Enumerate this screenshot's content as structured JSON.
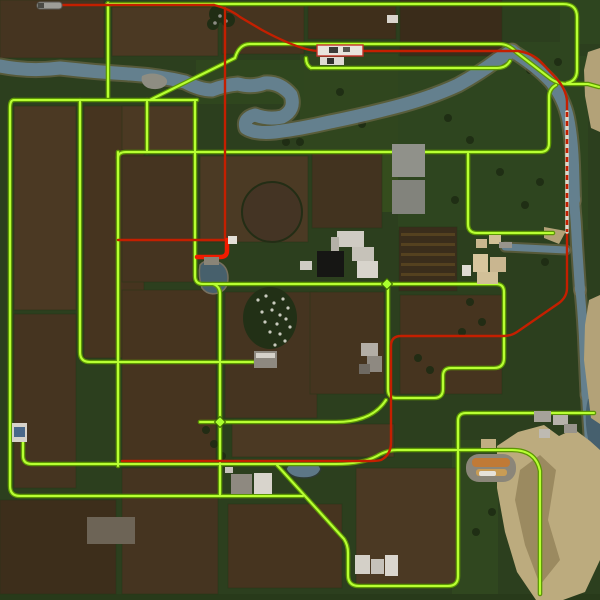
{
  "meta": {
    "type": "game-minimap",
    "description": "Top-down farming-game overview map: brown field grid, meandering river, road network highlighted bright green, railway route highlighted red, farms, ponds, racetrack and cliffs",
    "visible_text": []
  },
  "colors": {
    "base_grass": "#2c3f1e",
    "road_core": "#b8ff33",
    "road_casing": "#5c9604",
    "rail_red": "#c41f00",
    "rail_red_bright": "#f01b00",
    "river": "#64808e",
    "river_bank": "#7b7152",
    "cliff_tan": "#b3a278",
    "field_brown": "#46341f"
  },
  "map": {
    "width": 600,
    "height": 600,
    "base": "#2c3f1e",
    "patches": [
      [
        398,
        56,
        190,
        174,
        "#2e451f"
      ],
      [
        452,
        440,
        46,
        156,
        "#30471f"
      ],
      [
        198,
        416,
        36,
        52,
        "#2a3f1c"
      ],
      [
        300,
        54,
        98,
        96,
        "#30461e"
      ],
      [
        352,
        150,
        46,
        62,
        "#354d1d"
      ],
      [
        505,
        42,
        72,
        38,
        "#2e451f"
      ],
      [
        560,
        0,
        40,
        44,
        "#2e451f"
      ],
      [
        196,
        60,
        108,
        44,
        "#2f461e"
      ],
      [
        0,
        594,
        600,
        6,
        "#283a1a"
      ]
    ],
    "fields": [
      [
        0,
        0,
        104,
        58,
        "#453420"
      ],
      [
        112,
        7,
        106,
        49,
        "#4b3923"
      ],
      [
        222,
        6,
        82,
        48,
        "#46341f"
      ],
      [
        308,
        6,
        88,
        33,
        "#3f2f1b"
      ],
      [
        400,
        0,
        102,
        56,
        "#3a2c1a"
      ],
      [
        14,
        106,
        62,
        204,
        "#4b3923"
      ],
      [
        14,
        314,
        62,
        174,
        "#453420"
      ],
      [
        84,
        106,
        60,
        252,
        "#46341f"
      ],
      [
        122,
        106,
        74,
        44,
        "#4b3923"
      ],
      [
        122,
        156,
        71,
        126,
        "#453420"
      ],
      [
        200,
        156,
        108,
        86,
        "#4b3a24"
      ],
      [
        122,
        290,
        94,
        170,
        "#46341f"
      ],
      [
        225,
        292,
        92,
        126,
        "#453420"
      ],
      [
        312,
        152,
        70,
        76,
        "#42331f"
      ],
      [
        399,
        227,
        58,
        64,
        "#3a2d1b"
      ],
      [
        400,
        295,
        102,
        99,
        "#46341f"
      ],
      [
        310,
        292,
        74,
        102,
        "#45341f"
      ],
      [
        232,
        424,
        162,
        33,
        "#4b3923"
      ],
      [
        122,
        468,
        96,
        126,
        "#453420"
      ],
      [
        228,
        504,
        114,
        84,
        "#46341f"
      ],
      [
        356,
        468,
        100,
        116,
        "#4b3923"
      ],
      [
        0,
        500,
        116,
        94,
        "#3d2e1b"
      ]
    ],
    "field_rows": [
      [
        401,
        233,
        54,
        3,
        "#54411f"
      ],
      [
        401,
        243,
        54,
        3,
        "#54411f"
      ],
      [
        401,
        253,
        54,
        3,
        "#54411f"
      ],
      [
        401,
        263,
        54,
        3,
        "#54411f"
      ],
      [
        401,
        273,
        54,
        3,
        "#54411f"
      ]
    ],
    "circle_field": {
      "cx": 272,
      "cy": 212,
      "r": 30,
      "fill": "#443424",
      "stroke": "#232d15"
    },
    "orchard": {
      "cx": 270,
      "cy": 318,
      "rx": 27,
      "ry": 31,
      "fill": "#223016",
      "dot_color": "#c9cabe",
      "dots": [
        [
          258,
          300
        ],
        [
          266,
          296
        ],
        [
          274,
          303
        ],
        [
          283,
          299
        ],
        [
          262,
          312
        ],
        [
          272,
          310
        ],
        [
          280,
          315
        ],
        [
          288,
          308
        ],
        [
          265,
          322
        ],
        [
          277,
          324
        ],
        [
          286,
          319
        ],
        [
          270,
          332
        ],
        [
          280,
          334
        ],
        [
          290,
          327
        ],
        [
          285,
          341
        ],
        [
          275,
          345
        ]
      ]
    },
    "water": {
      "stroke": "#64808e",
      "bank": "#7b7152",
      "river_paths": [
        {
          "d": "M0,66 Q30,72 60,68 Q95,72 130,74 Q160,76 185,82 Q200,90 212,90 Q225,85 238,84 Q252,88 265,83 Q280,82 291,95 Q296,110 282,117 Q268,120 255,115 Q243,118 246,128 Q255,134 275,132 Q300,129 330,122 Q360,116 395,107 Q430,98 458,85 Q480,73 497,60 L512,51",
          "w": 13
        },
        {
          "d": "M512,51 Q535,65 551,82 Q564,99 568,118 Q572,138 573,165 L574,200",
          "w": 12
        },
        {
          "d": "M574,200 Q576,222 577,245 L580,290",
          "w": 10
        },
        {
          "d": "M580,290 Q583,320 584,350 L586,395",
          "w": 9
        },
        {
          "d": "M586,395 Q588,430 590,455 L592,478",
          "w": 8
        },
        {
          "d": "M505,247 L566,250",
          "w": 7
        }
      ],
      "shapes": [
        {
          "d": "M286,469 Q289,461 302,461 Q317,459 321,469 Q318,478 304,478 Q290,478 286,469 Z",
          "fill": "#5d7787",
          "stroke": "#2e3b33"
        },
        {
          "d": "M200,265 Q198,276 202,288 Q208,296 218,293 Q228,290 228,278 Q228,266 218,262 Q206,258 200,265 Z",
          "fill": "#47606c",
          "stroke": "#77705f"
        },
        {
          "d": "M142,76 Q140,84 148,88 Q158,91 165,86 Q170,80 163,76 Q152,71 142,76 Z",
          "fill": "#8e8d82",
          "stroke": "none"
        },
        {
          "d": "M600,396 L588,399 Q583,418 589,443 Q592,463 600,472 Z",
          "fill": "#46606e",
          "stroke": "none"
        }
      ]
    },
    "cliffs": [
      {
        "points": "588,52 600,48 600,132 591,128 585,96 584,70",
        "fill": "#b3a278"
      },
      {
        "points": "589,300 600,295 600,424 591,418 584,360 585,325",
        "fill": "#b3a278"
      },
      {
        "points": "497,446 518,432 544,425 559,436 574,429 590,441 600,450 600,560 585,592 563,600 536,600 517,572 505,532 497,488",
        "fill": "#bcab7e"
      },
      {
        "points": "520,470 540,455 556,470 548,520 560,560 540,585 525,545 515,500",
        "fill": "#9b8a60"
      },
      {
        "points": "544,227 566,231 559,244 544,238",
        "fill": "#b3a278"
      }
    ],
    "roads": {
      "casing": "#5c9604",
      "core": "#b8ff33",
      "width_casing": 4.6,
      "width_core": 2.1,
      "paths": [
        "M108,3 V97",
        "M107,4 H563 Q577,4 577,17 V70 Q577,81 567,83",
        "M250,44 H499 Q509,44 516,52 L551,79 Q558,84 568,84 H588 L599,87",
        "M311,68 H497 Q506,68 510,61",
        "M311,68 Q306,65 306,58",
        "M150,100 L235,58 Q239,44 250,44",
        "M14,100 H197",
        "M14,100 Q10,100 10,108 V486 Q10,496 20,496 H303",
        "M80,100 V352 Q80,362 90,362 H253",
        "M147,100 V152",
        "M118,158 Q118,152 126,152 H540 Q549,152 549,143 V97 Q549,89 556,85",
        "M118,152 V466",
        "M195,101 V276 Q195,284 203,284",
        "M203,284 H496 Q504,284 504,292 V358 Q504,368 494,368 H451 Q443,368 443,376 V389 Q443,398 434,398 H396 Q388,398 388,389 V284",
        "M213,284 Q220,286 220,294 V496",
        "M200,422 H336 Q372,422 386,400",
        "M23,432 V456 Q23,464 32,464 H336 Q362,464 377,456 Q387,450 397,450 H512 Q536,450 540,471 V594",
        "M277,465 L344,539 Q348,545 348,553 V575 Q348,586 359,586 H448 Q458,586 458,576 V421 Q458,413 466,413 H594",
        "M468,153 V224 Q468,233 477,233 H553"
      ]
    },
    "rail": {
      "color": "#c41f00",
      "thick_color": "#f01b00",
      "bridge_tie": "#dcd8ca",
      "paths_solid": [
        "M48,5 H214",
        "M214,5 Q230,9 240,17 L262,30 Q288,44 306,49 Q313,51 321,51 H518 Q532,53 541,62 L556,78 Q566,89 567,101 V112",
        "M567,232 V288 Q567,297 559,303 L517,332 Q511,336 503,336 H401 Q391,336 391,346 V442 Q391,455 381,460 Q377,461 371,461 H122",
        "M225,8 V240",
        "M118,240 H227"
      ],
      "path_dashed": "M567,112 V232",
      "paths_thick": [
        "M227,240 V251 Q227,257 220,257 H197"
      ]
    },
    "racetrack": {
      "outer": [
        466,
        454,
        50,
        28,
        13,
        "#8b8679"
      ],
      "stripes": [
        [
          472,
          458,
          38,
          9,
          4,
          "#c07a36"
        ],
        [
          476,
          469,
          31,
          7,
          3,
          "#c89c55"
        ],
        [
          479,
          471,
          17,
          5,
          2,
          "#e6e2da"
        ]
      ]
    },
    "buildings": [
      [
        317,
        45,
        46,
        11,
        "#e8e4dc",
        "#c23026"
      ],
      [
        329,
        47,
        9,
        6,
        "#3c3c38",
        ""
      ],
      [
        343,
        47,
        7,
        5,
        "#565650",
        ""
      ],
      [
        320,
        57,
        24,
        8,
        "#dedad2",
        ""
      ],
      [
        327,
        58,
        7,
        6,
        "#30302c",
        ""
      ],
      [
        387,
        15,
        11,
        8,
        "#d9d5cd",
        ""
      ],
      [
        392,
        144,
        33,
        33,
        "#90918a",
        ""
      ],
      [
        392,
        180,
        33,
        34,
        "#82837c",
        ""
      ],
      [
        337,
        231,
        27,
        16,
        "#cfcbc3",
        ""
      ],
      [
        352,
        247,
        22,
        14,
        "#c6c2b9",
        ""
      ],
      [
        357,
        261,
        21,
        17,
        "#d8d4cc",
        ""
      ],
      [
        331,
        237,
        8,
        22,
        "#b4b0a7",
        ""
      ],
      [
        317,
        251,
        27,
        26,
        "#161614",
        ""
      ],
      [
        300,
        261,
        12,
        9,
        "#cfcbc3",
        ""
      ],
      [
        476,
        239,
        11,
        9,
        "#c9b68e",
        ""
      ],
      [
        489,
        235,
        12,
        9,
        "#d2c096",
        ""
      ],
      [
        473,
        254,
        15,
        18,
        "#d8c69e",
        ""
      ],
      [
        490,
        257,
        16,
        15,
        "#c9b690",
        ""
      ],
      [
        477,
        272,
        21,
        12,
        "#d2c098",
        ""
      ],
      [
        462,
        265,
        9,
        11,
        "#dfdbd3",
        ""
      ],
      [
        499,
        242,
        13,
        6,
        "#98948b",
        ""
      ],
      [
        361,
        343,
        17,
        13,
        "#b3aea6",
        ""
      ],
      [
        367,
        356,
        15,
        16,
        "#8e8981",
        ""
      ],
      [
        359,
        364,
        11,
        10,
        "#6e6961",
        ""
      ],
      [
        254,
        351,
        23,
        17,
        "#8e8980",
        ""
      ],
      [
        256,
        353,
        19,
        5,
        "#d6d2ca",
        ""
      ],
      [
        204,
        257,
        15,
        8,
        "#898477",
        ""
      ],
      [
        228,
        236,
        9,
        8,
        "#e3dfd7",
        ""
      ],
      [
        231,
        474,
        21,
        20,
        "#8e8980",
        ""
      ],
      [
        254,
        473,
        18,
        21,
        "#d8d4cc",
        ""
      ],
      [
        225,
        467,
        8,
        6,
        "#c6c2ba",
        ""
      ],
      [
        355,
        555,
        15,
        19,
        "#d4d0c8",
        ""
      ],
      [
        371,
        559,
        13,
        15,
        "#c6c2ba",
        ""
      ],
      [
        385,
        555,
        13,
        21,
        "#dad6ce",
        ""
      ],
      [
        534,
        411,
        17,
        11,
        "#a6a29a",
        ""
      ],
      [
        553,
        415,
        15,
        10,
        "#b6b2aa",
        ""
      ],
      [
        564,
        424,
        13,
        9,
        "#98948c",
        ""
      ],
      [
        539,
        429,
        11,
        9,
        "#bebab2",
        ""
      ],
      [
        481,
        439,
        15,
        9,
        "#c0ae82",
        ""
      ],
      [
        12,
        423,
        15,
        19,
        "#d6d2ca",
        ""
      ],
      [
        14,
        427,
        11,
        10,
        "#49688a",
        ""
      ],
      [
        87,
        517,
        48,
        27,
        "#6d6456",
        ""
      ]
    ],
    "top_tree": {
      "circles": [
        [
          218,
          14,
          9
        ],
        [
          228,
          20,
          7
        ],
        [
          213,
          24,
          6
        ]
      ],
      "fill": "#202d14",
      "speckles": [
        [
          220,
          16
        ],
        [
          226,
          21
        ],
        [
          215,
          23
        ]
      ],
      "speckle_color": "#8d8d85"
    },
    "tree_dots": {
      "color": "#1e2b13",
      "r": 4,
      "points": [
        [
          432,
          92
        ],
        [
          448,
          118
        ],
        [
          470,
          140
        ],
        [
          500,
          172
        ],
        [
          455,
          200
        ],
        [
          540,
          182
        ],
        [
          340,
          92
        ],
        [
          362,
          124
        ],
        [
          300,
          142
        ],
        [
          206,
          430
        ],
        [
          214,
          444
        ],
        [
          222,
          456
        ],
        [
          470,
          302
        ],
        [
          482,
          322
        ],
        [
          462,
          332
        ],
        [
          492,
          512
        ],
        [
          476,
          532
        ],
        [
          530,
          70
        ],
        [
          558,
          62
        ],
        [
          252,
          120
        ],
        [
          286,
          142
        ],
        [
          525,
          205
        ],
        [
          545,
          262
        ],
        [
          430,
          370
        ],
        [
          418,
          358
        ]
      ]
    },
    "nodes": {
      "points": [
        [
          387,
          284
        ],
        [
          220,
          422
        ]
      ],
      "size": 5.5,
      "fill": "#aaff2e",
      "stroke": "#3f6b00"
    },
    "train": {
      "x": 37,
      "y": 2,
      "w": 25,
      "h": 7,
      "fill": "#9e9e98",
      "stroke": "#5a5a54",
      "cab": [
        38,
        3,
        6,
        5,
        "#4a4a44"
      ]
    }
  }
}
